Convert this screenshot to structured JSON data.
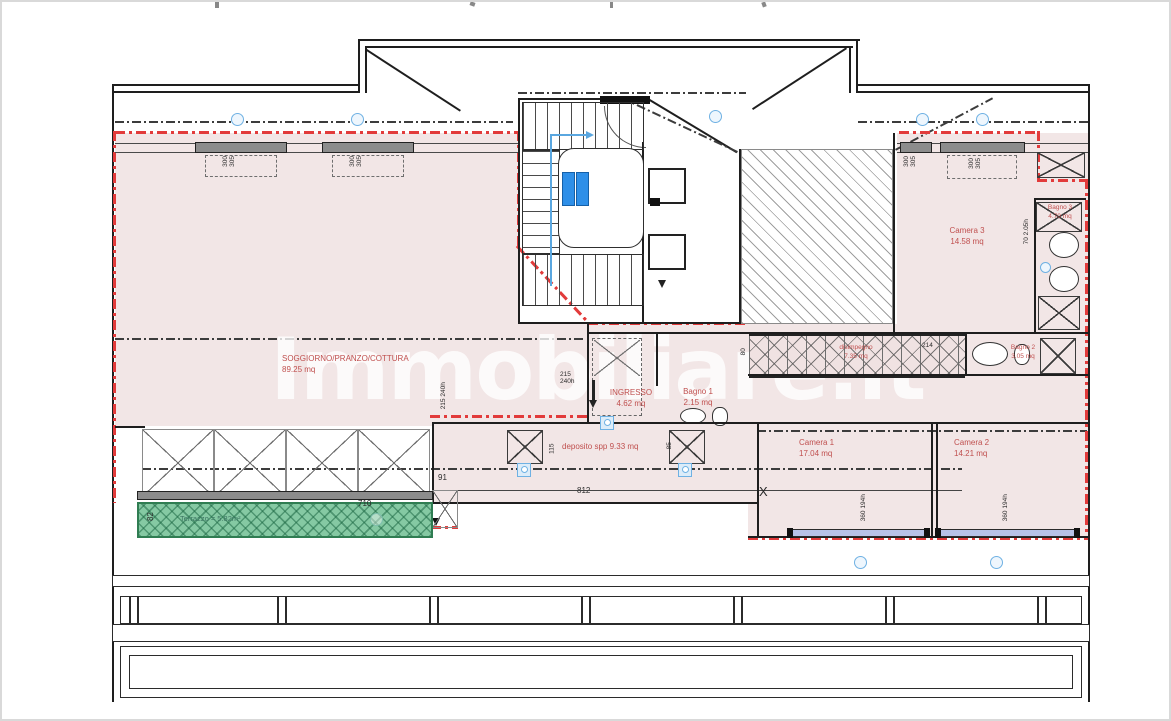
{
  "watermark": {
    "text": "Immobiliare.it"
  },
  "colors": {
    "boundary_red": "#e23b3b",
    "room_pink": "#f2e6e6",
    "terrace_green": "#85c9a3",
    "lift_blue": "#2e8fe8",
    "marker_blue": "#6fb1e3",
    "label_red": "#c0504f"
  },
  "rooms": {
    "soggiorno": {
      "label": "SOGGIORNO/PRANZO/COTTURA",
      "area": "89.25 mq"
    },
    "ingresso": {
      "label": "INGRESSO",
      "area": "4.62 mq"
    },
    "bagno1": {
      "label": "Bagno 1",
      "area": "2.15 mq"
    },
    "bagno2": {
      "label": "Bagno 2",
      "area": "3.05 mq"
    },
    "bagno3": {
      "label": "Bagno 3",
      "area": "4.70 mq"
    },
    "camera1": {
      "label": "Camera 1",
      "area": "17.04 mq"
    },
    "camera2": {
      "label": "Camera 2",
      "area": "14.21 mq"
    },
    "camera3": {
      "label": "Camera 3",
      "area": "14.58 mq"
    },
    "disimpegno": {
      "label": "disimpegno",
      "area": "7.35 mq"
    },
    "deposito": {
      "label": "deposito spp 9.33 mq"
    },
    "terrazzo": {
      "label": "Terrazzo = 5.82m²"
    }
  },
  "dimensions": {
    "terrace_width": "710",
    "terrace_depth": "82",
    "step": "91",
    "corridor_length": "812",
    "dep_h1": "115",
    "dep_h2": "85",
    "corr_w": "80",
    "corr_seg": "214",
    "ing_w": "215",
    "ing_h": "240h",
    "sky_w": "300",
    "sky_l": "305",
    "win_w": "360",
    "win_h": "194h",
    "c3_w": "70",
    "c3_h": "2.05h",
    "x_mark": "X"
  }
}
